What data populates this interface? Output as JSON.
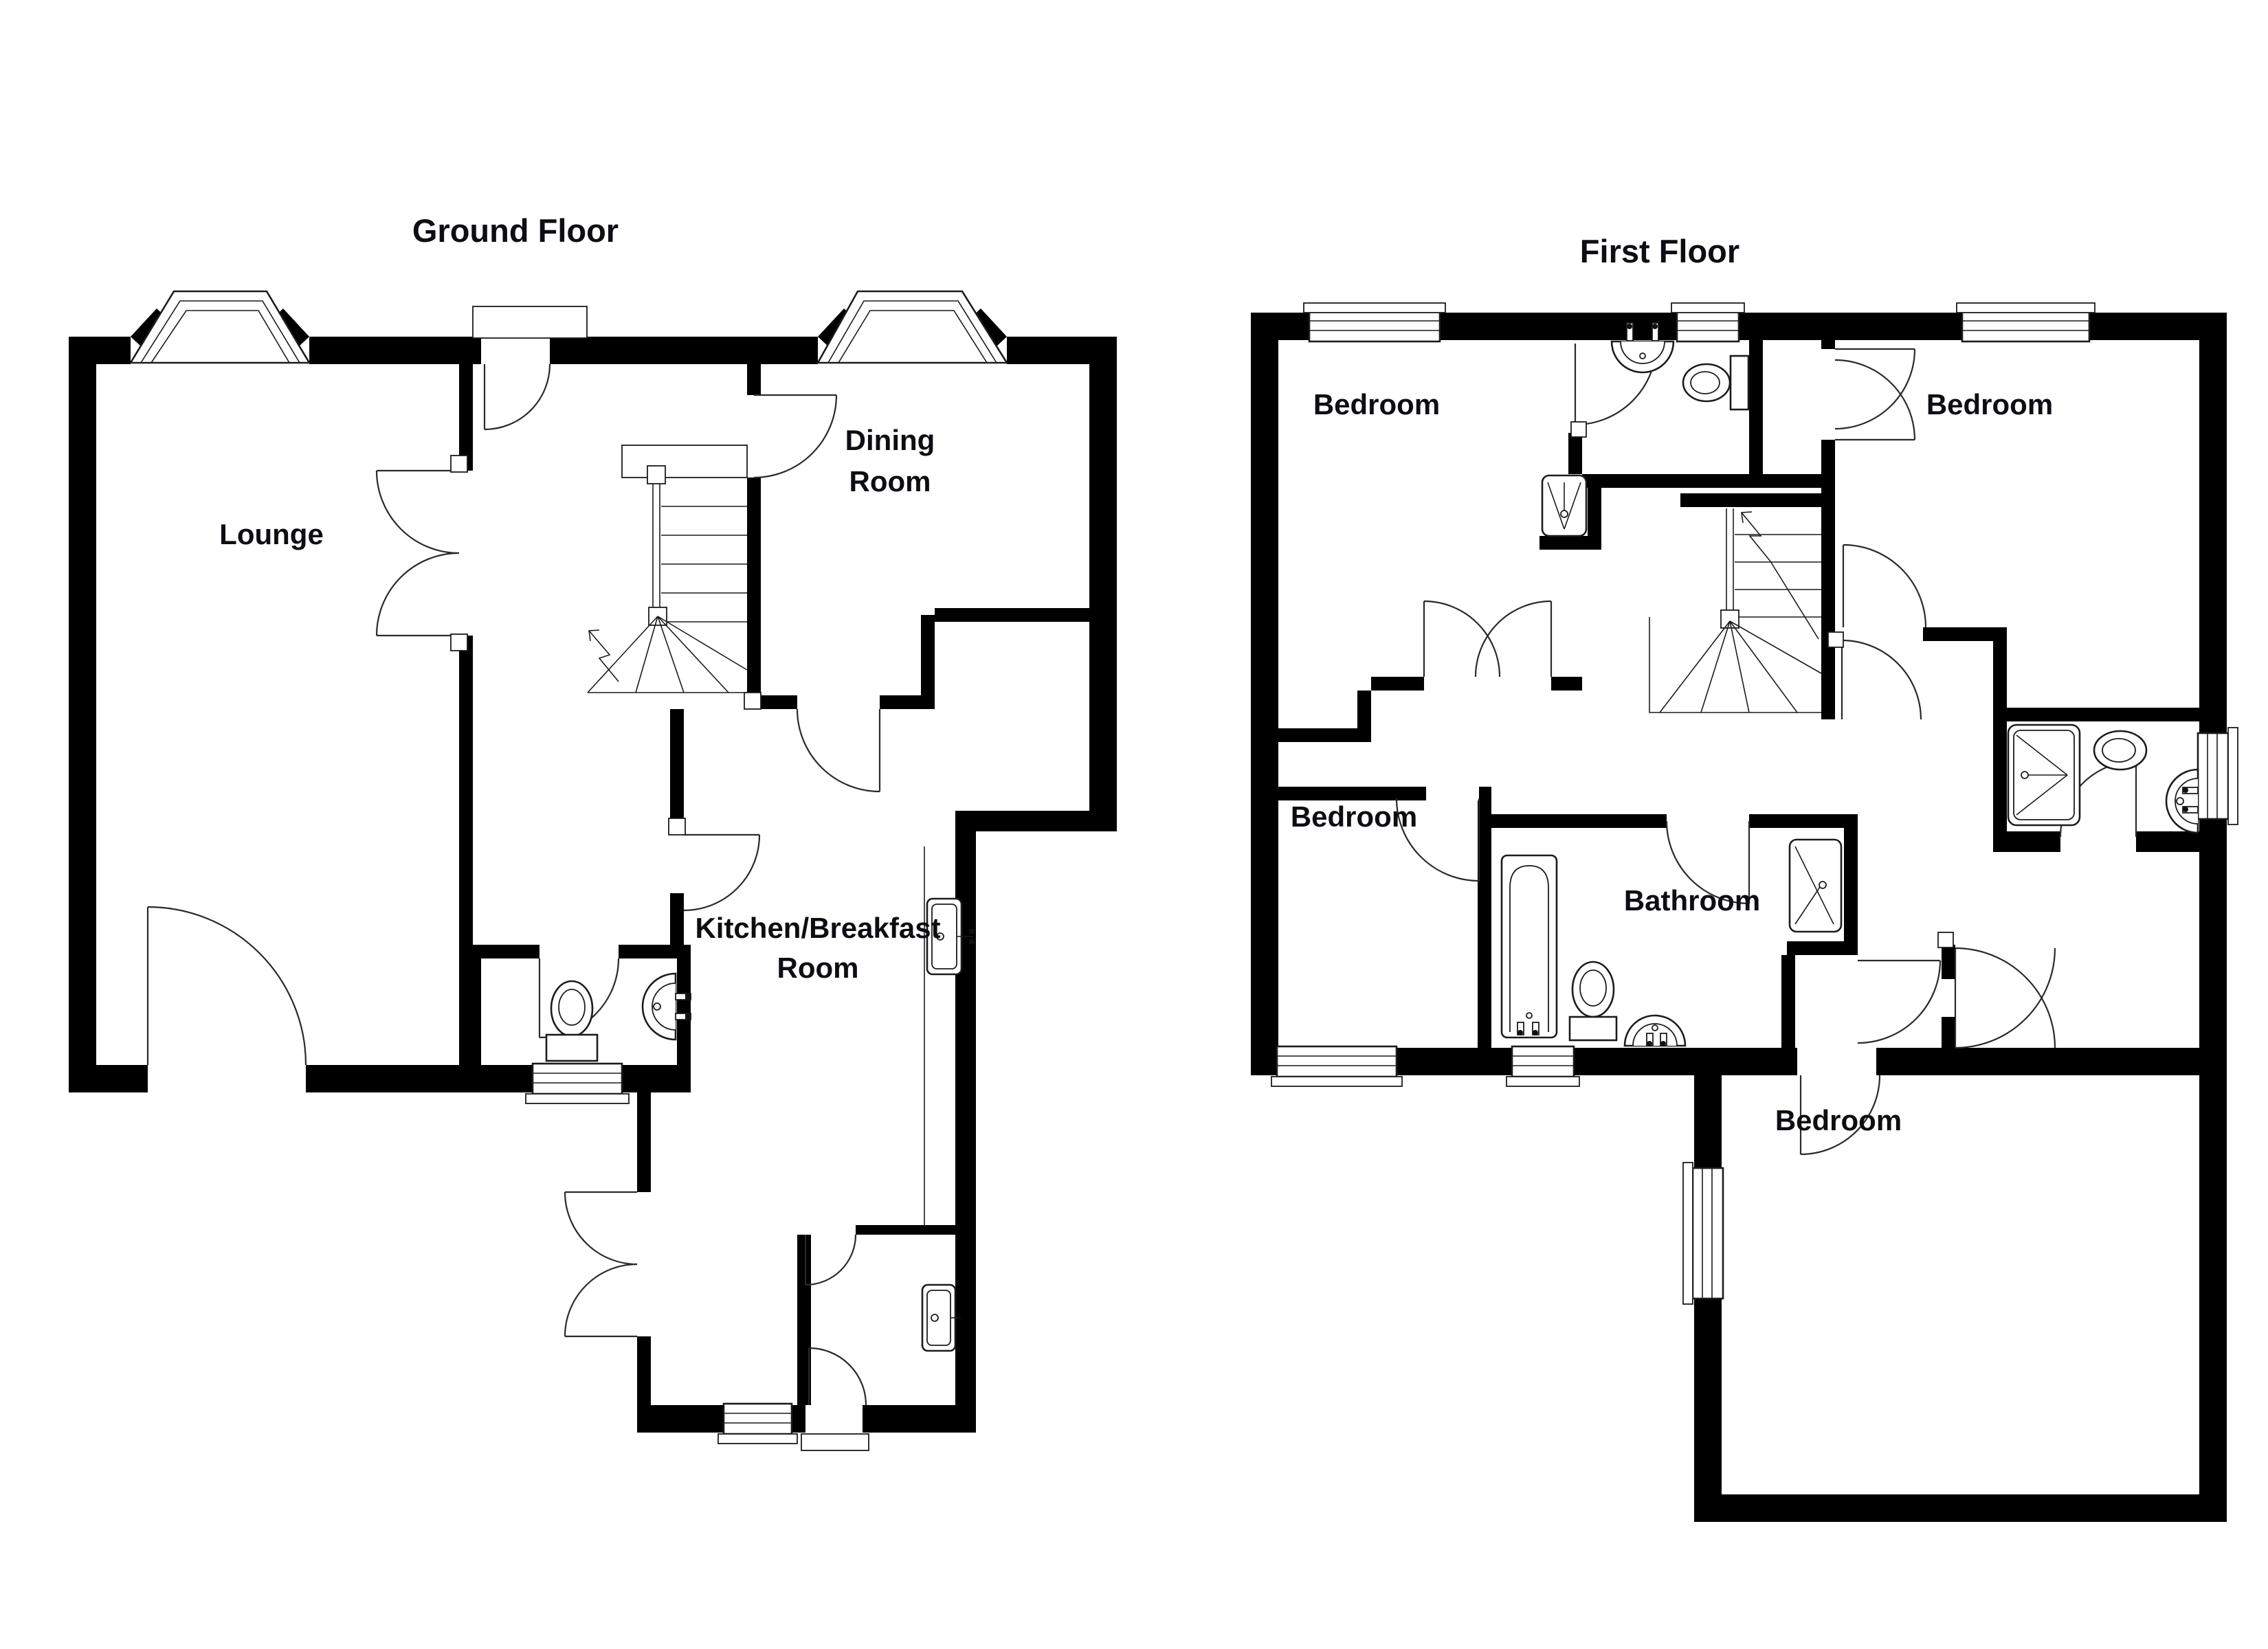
{
  "page": {
    "background": "#ffffff",
    "wall_color": "#000000",
    "line_color": "#1c1c1c",
    "label_color": "#0d0d14"
  },
  "floors": [
    {
      "id": "ground-floor",
      "title": "Ground Floor",
      "rooms": [
        {
          "name": "lounge",
          "lines": [
            "Lounge"
          ]
        },
        {
          "name": "dining-room",
          "lines": [
            "Dining",
            "Room"
          ]
        },
        {
          "name": "kitchen-breakfast-room",
          "lines": [
            "Kitchen/Breakfast",
            "Room"
          ]
        }
      ],
      "fixtures": [
        "staircase",
        "toilet",
        "pedestal-sink",
        "kitchen-sink",
        "kitchen-sink",
        "bay-window",
        "bay-window",
        "window",
        "window"
      ]
    },
    {
      "id": "first-floor",
      "title": "First Floor",
      "rooms": [
        {
          "name": "bedroom-front-left",
          "lines": [
            "Bedroom"
          ]
        },
        {
          "name": "bedroom-front-right",
          "lines": [
            "Bedroom"
          ]
        },
        {
          "name": "bedroom-middle-left",
          "lines": [
            "Bedroom"
          ]
        },
        {
          "name": "bathroom",
          "lines": [
            "Bathroom"
          ]
        },
        {
          "name": "bedroom-rear",
          "lines": [
            "Bedroom"
          ]
        }
      ],
      "fixtures": [
        "staircase",
        "pedestal-sink",
        "toilet",
        "shower",
        "shower",
        "toilet",
        "pedestal-sink",
        "shower",
        "bath",
        "toilet",
        "pedestal-sink",
        "window",
        "window",
        "window",
        "window",
        "window",
        "window"
      ]
    }
  ]
}
